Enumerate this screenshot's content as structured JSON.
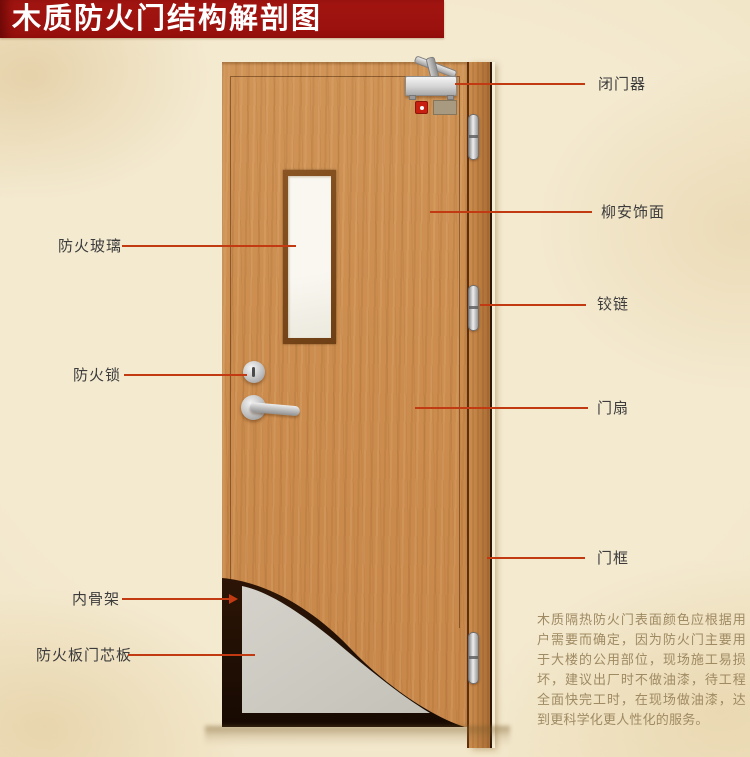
{
  "title": "木质防火门结构解剖图",
  "annotations": {
    "fire_glass": "防火玻璃",
    "fire_lock": "防火锁",
    "inner_skeleton": "内骨架",
    "fire_board_core": "防火板门芯板",
    "door_closer": "闭门器",
    "lauan_veneer": "柳安饰面",
    "hinge": "铰链",
    "door_leaf": "门扇",
    "door_frame": "门框"
  },
  "description": "木质隔热防火门表面颜色应根据用户需要而确定，因为防火门主要用于大楼的公用部位，现场施工易损坏，建议出厂时不做油漆，待工程全面快完工时，在现场做油漆，达到更科学化更人性化的服务。",
  "colors": {
    "banner": "#9c120e",
    "leader_line": "#c23a12",
    "background": "#f2e7c9",
    "wood": "#cc8d4e",
    "core_gray": "#cdcbc2",
    "skeleton_dark": "#200f04"
  }
}
